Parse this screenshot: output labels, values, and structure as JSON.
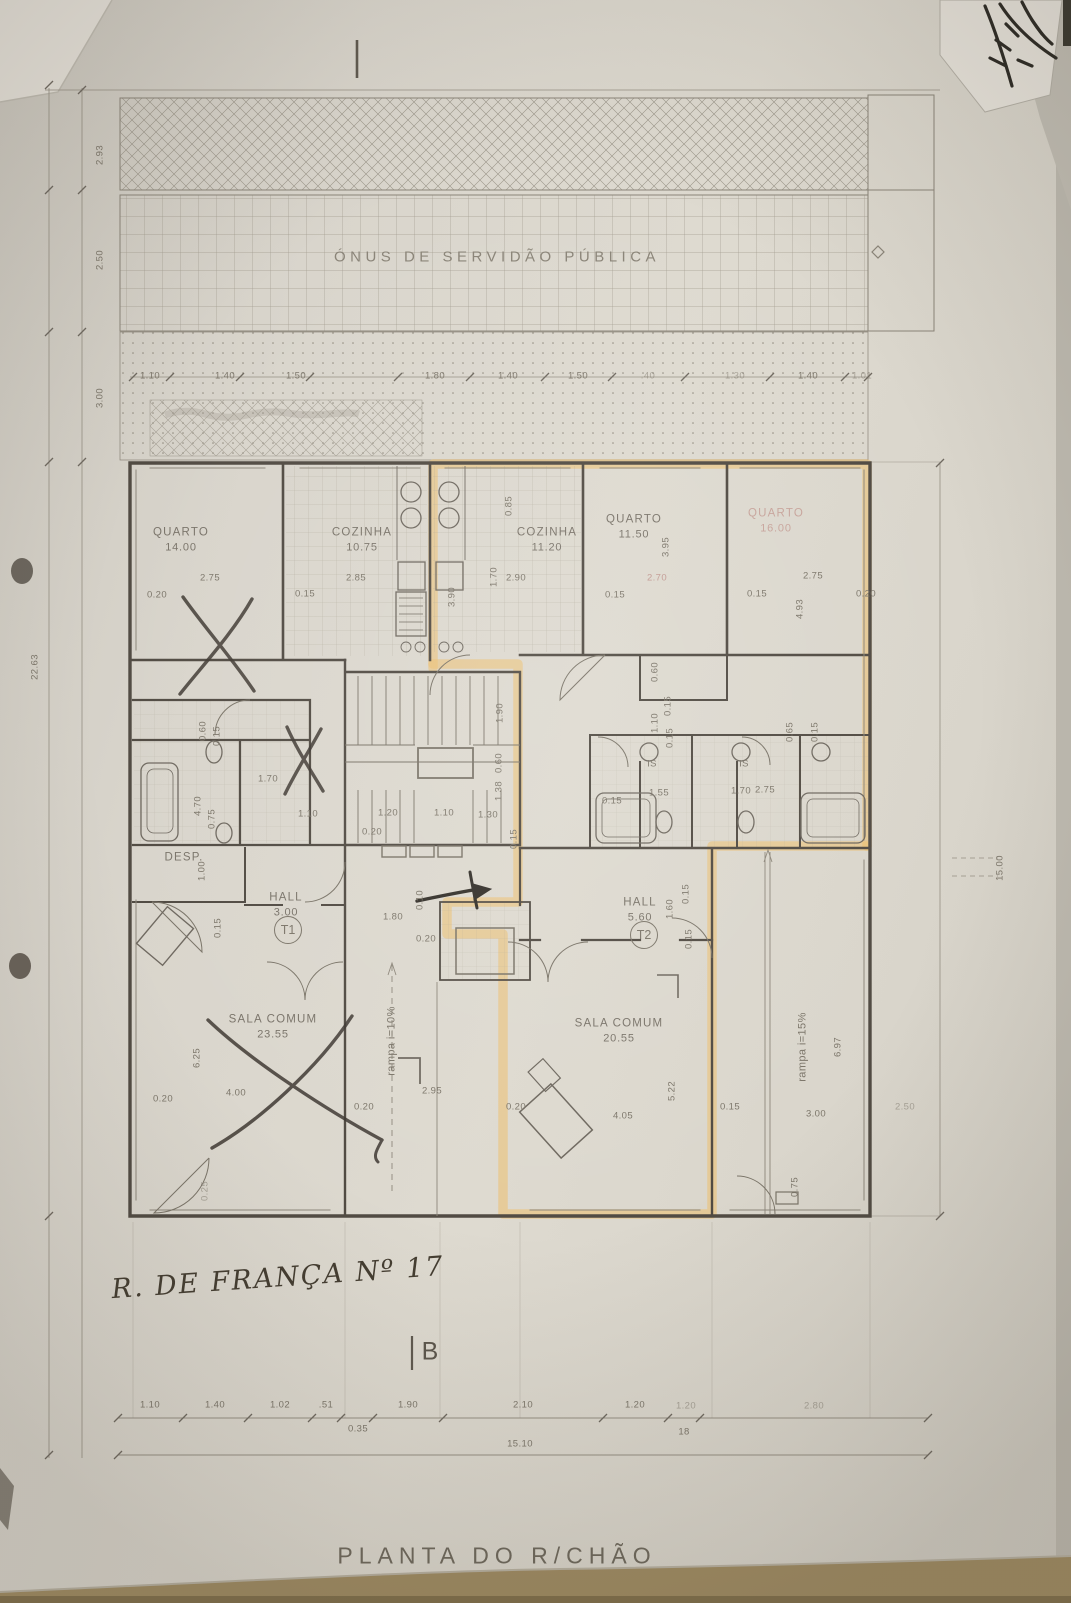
{
  "annotations": {
    "servitude": "ÓNUS DE SERVIDÃO PÚBLICA",
    "address": "R. DE FRANÇA Nº 17",
    "section_letter": "B",
    "caption": "PLANTA DO R/CHÃO"
  },
  "totals": {
    "bottom_width": "15.10",
    "right_height": "15.00",
    "left_height": "22.63"
  },
  "units": [
    {
      "id": "T1",
      "x": 288,
      "y": 930
    },
    {
      "id": "T2",
      "x": 644,
      "y": 935
    }
  ],
  "rooms": [
    {
      "name": "QUARTO",
      "area": "14.00",
      "x": 181,
      "y": 540
    },
    {
      "name": "COZINHA",
      "area": "10.75",
      "x": 362,
      "y": 540
    },
    {
      "name": "COZINHA",
      "area": "11.20",
      "x": 547,
      "y": 540
    },
    {
      "name": "QUARTO",
      "area": "11.50",
      "x": 634,
      "y": 527
    },
    {
      "name": "QUARTO",
      "area": "16.00",
      "x": 776,
      "y": 521,
      "c": "red"
    },
    {
      "name": "SALA COMUM",
      "area": "23.55",
      "x": 273,
      "y": 1027
    },
    {
      "name": "SALA COMUM",
      "area": "20.55",
      "x": 619,
      "y": 1031
    },
    {
      "name": "HALL",
      "area": "3.00",
      "x": 286,
      "y": 905
    },
    {
      "name": "HALL",
      "area": "5.60",
      "x": 640,
      "y": 910
    },
    {
      "name": "DESP.",
      "area": "",
      "x": 184,
      "y": 858
    }
  ],
  "dim_labels": [
    {
      "t": "1.10",
      "x": 150,
      "y": 376
    },
    {
      "t": "1.40",
      "x": 225,
      "y": 376
    },
    {
      "t": "1.50",
      "x": 296,
      "y": 376
    },
    {
      "t": "1.80",
      "x": 435,
      "y": 376
    },
    {
      "t": "1.40",
      "x": 508,
      "y": 376
    },
    {
      "t": "1.50",
      "x": 578,
      "y": 376
    },
    {
      "t": ".40",
      "x": 648,
      "y": 376,
      "c": "faint"
    },
    {
      "t": "1.30",
      "x": 735,
      "y": 376,
      "c": "faint"
    },
    {
      "t": "1.40",
      "x": 808,
      "y": 376
    },
    {
      "t": "1.01",
      "x": 862,
      "y": 376,
      "c": "faint"
    },
    {
      "t": "2.93",
      "x": 100,
      "y": 155,
      "r": 1
    },
    {
      "t": "2.50",
      "x": 100,
      "y": 260,
      "r": 1
    },
    {
      "t": "3.00",
      "x": 100,
      "y": 398,
      "r": 1
    },
    {
      "t": "22.63",
      "x": 35,
      "y": 667,
      "r": 1
    },
    {
      "t": "15.00",
      "x": 1000,
      "y": 868,
      "r": 1
    },
    {
      "t": "2.75",
      "x": 210,
      "y": 578
    },
    {
      "t": "2.85",
      "x": 356,
      "y": 578
    },
    {
      "t": "1.70",
      "x": 494,
      "y": 577,
      "r": 1
    },
    {
      "t": "2.90",
      "x": 516,
      "y": 578
    },
    {
      "t": "2.70",
      "x": 657,
      "y": 578,
      "c": "red"
    },
    {
      "t": "3.95",
      "x": 666,
      "y": 547,
      "r": 1
    },
    {
      "t": "2.75",
      "x": 813,
      "y": 576
    },
    {
      "t": "4.93",
      "x": 800,
      "y": 609,
      "r": 1
    },
    {
      "t": "0.85",
      "x": 509,
      "y": 506,
      "r": 1
    },
    {
      "t": "0.20",
      "x": 157,
      "y": 595
    },
    {
      "t": "0.15",
      "x": 305,
      "y": 594
    },
    {
      "t": "3.90",
      "x": 452,
      "y": 597,
      "r": 1
    },
    {
      "t": "0.15",
      "x": 615,
      "y": 595
    },
    {
      "t": "0.15",
      "x": 757,
      "y": 594
    },
    {
      "t": "0.20",
      "x": 866,
      "y": 594
    },
    {
      "t": "0.60",
      "x": 203,
      "y": 731,
      "r": 1
    },
    {
      "t": "0.15",
      "x": 217,
      "y": 736,
      "r": 1
    },
    {
      "t": "1.70",
      "x": 268,
      "y": 779
    },
    {
      "t": "4.70",
      "x": 198,
      "y": 806,
      "r": 1
    },
    {
      "t": "0.75",
      "x": 212,
      "y": 819,
      "r": 1
    },
    {
      "t": "1.10",
      "x": 308,
      "y": 814
    },
    {
      "t": "1.00",
      "x": 202,
      "y": 871,
      "r": 1
    },
    {
      "t": "0.15",
      "x": 218,
      "y": 928,
      "r": 1
    },
    {
      "t": "1.80",
      "x": 393,
      "y": 917
    },
    {
      "t": "0.20",
      "x": 426,
      "y": 939
    },
    {
      "t": "1.90",
      "x": 500,
      "y": 713,
      "r": 1
    },
    {
      "t": "0.60",
      "x": 499,
      "y": 763,
      "r": 1
    },
    {
      "t": "1.38",
      "x": 499,
      "y": 791,
      "r": 1
    },
    {
      "t": "1.20",
      "x": 388,
      "y": 813
    },
    {
      "t": "1.10",
      "x": 444,
      "y": 813
    },
    {
      "t": "1.30",
      "x": 488,
      "y": 815
    },
    {
      "t": "0.20",
      "x": 372,
      "y": 832
    },
    {
      "t": "0.15",
      "x": 514,
      "y": 839,
      "r": 1
    },
    {
      "t": "0.10",
      "x": 420,
      "y": 900,
      "r": 1
    },
    {
      "t": "0.60",
      "x": 655,
      "y": 672,
      "r": 1
    },
    {
      "t": "0.15",
      "x": 668,
      "y": 706,
      "r": 1
    },
    {
      "t": "1.10",
      "x": 655,
      "y": 723,
      "r": 1
    },
    {
      "t": "0.15",
      "x": 670,
      "y": 738,
      "r": 1
    },
    {
      "t": "IS",
      "x": 652,
      "y": 764
    },
    {
      "t": "IS",
      "x": 744,
      "y": 764
    },
    {
      "t": "0.15",
      "x": 612,
      "y": 801
    },
    {
      "t": "1.55",
      "x": 659,
      "y": 793
    },
    {
      "t": "1.70",
      "x": 741,
      "y": 791
    },
    {
      "t": "2.75",
      "x": 765,
      "y": 790
    },
    {
      "t": "0.65",
      "x": 790,
      "y": 732,
      "r": 1
    },
    {
      "t": "0.15",
      "x": 815,
      "y": 732,
      "r": 1
    },
    {
      "t": "1.60",
      "x": 670,
      "y": 909,
      "r": 1
    },
    {
      "t": "0.15",
      "x": 686,
      "y": 894,
      "r": 1
    },
    {
      "t": "0.15",
      "x": 689,
      "y": 939,
      "r": 1
    },
    {
      "t": "6.25",
      "x": 197,
      "y": 1058,
      "r": 1
    },
    {
      "t": "4.00",
      "x": 236,
      "y": 1093
    },
    {
      "t": "0.20",
      "x": 163,
      "y": 1099
    },
    {
      "t": "0.25",
      "x": 205,
      "y": 1191,
      "r": 1,
      "c": "faint"
    },
    {
      "t": "2.95",
      "x": 432,
      "y": 1091
    },
    {
      "t": "0.20",
      "x": 364,
      "y": 1107
    },
    {
      "t": "5.22",
      "x": 672,
      "y": 1091,
      "r": 1
    },
    {
      "t": "4.05",
      "x": 623,
      "y": 1116
    },
    {
      "t": "0.20",
      "x": 516,
      "y": 1107
    },
    {
      "t": "0.15",
      "x": 730,
      "y": 1107
    },
    {
      "t": "3.00",
      "x": 816,
      "y": 1114
    },
    {
      "t": "6.97",
      "x": 838,
      "y": 1047,
      "r": 1
    },
    {
      "t": "0.75",
      "x": 795,
      "y": 1187,
      "r": 1
    },
    {
      "t": "2.50",
      "x": 905,
      "y": 1107,
      "c": "faint"
    },
    {
      "t": "rampa i=10%",
      "x": 392,
      "y": 1041,
      "r": 1,
      "s": 11
    },
    {
      "t": "rampa i=15%",
      "x": 803,
      "y": 1047,
      "r": 1,
      "s": 11
    },
    {
      "t": "1.10",
      "x": 150,
      "y": 1405
    },
    {
      "t": "1.40",
      "x": 215,
      "y": 1405
    },
    {
      "t": "1.02",
      "x": 280,
      "y": 1405
    },
    {
      "t": ".51",
      "x": 326,
      "y": 1405
    },
    {
      "t": "1.90",
      "x": 408,
      "y": 1405
    },
    {
      "t": "2.10",
      "x": 523,
      "y": 1405
    },
    {
      "t": "1.20",
      "x": 635,
      "y": 1405
    },
    {
      "t": "1.20",
      "x": 686,
      "y": 1406,
      "c": "faint"
    },
    {
      "t": "2.80",
      "x": 814,
      "y": 1406,
      "c": "faint"
    },
    {
      "t": "0.35",
      "x": 358,
      "y": 1429
    },
    {
      "t": "18",
      "x": 684,
      "y": 1432
    },
    {
      "t": "15.10",
      "x": 520,
      "y": 1444
    }
  ]
}
